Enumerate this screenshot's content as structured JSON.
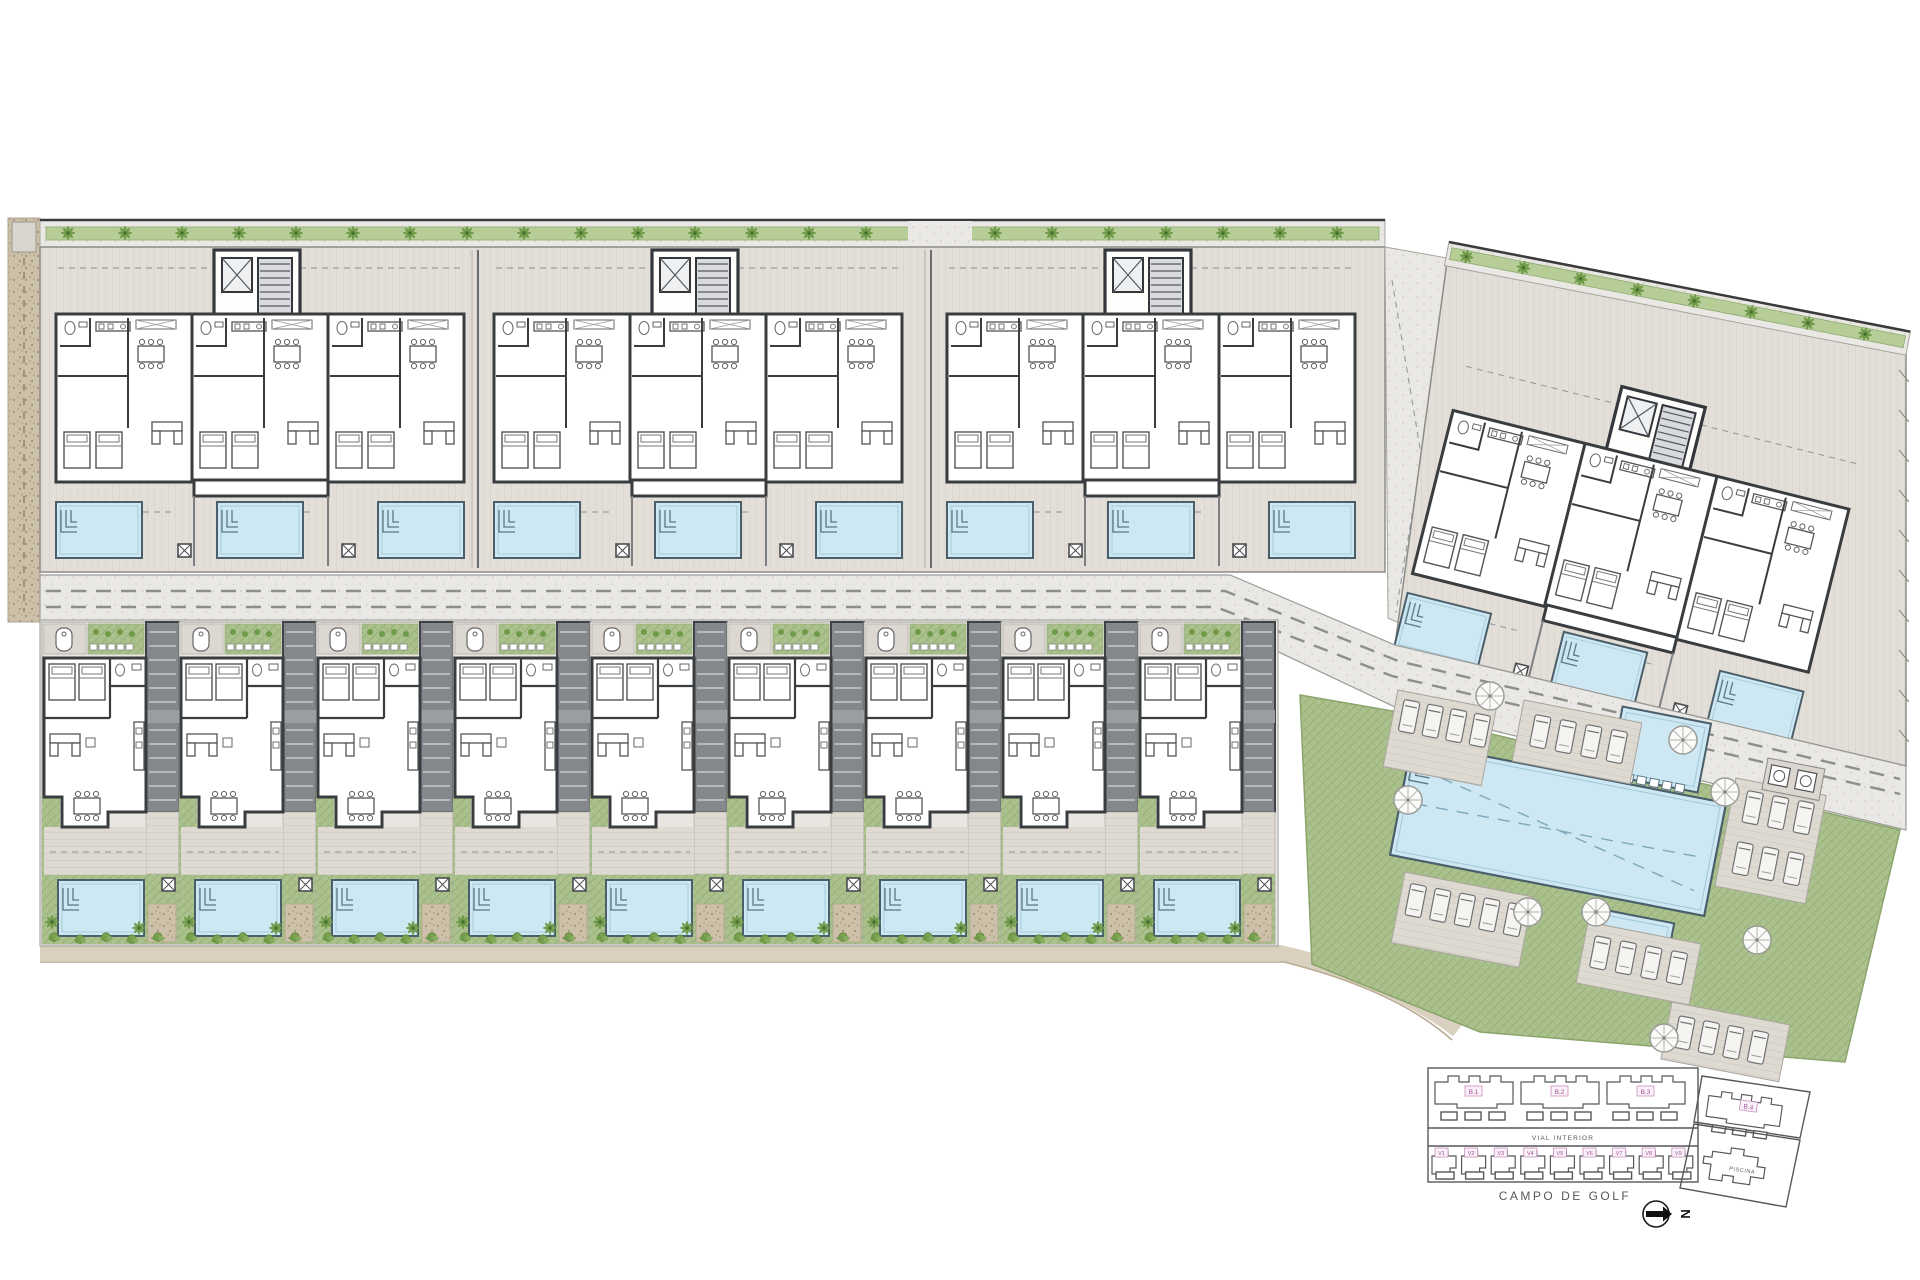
{
  "key_plan": {
    "buildings": [
      "B.1",
      "B.2",
      "B.3",
      "B.4"
    ],
    "villas": [
      "V1",
      "V2",
      "V3",
      "V4",
      "V5",
      "V6",
      "V7",
      "V8",
      "V9"
    ],
    "road_label": "VIAL INTERIOR",
    "pool_area_label": "PISCINA",
    "bottom_label": "CAMPO DE GOLF",
    "north_label": "N"
  },
  "site": {
    "apartment_block_count": 4,
    "villa_count": 9,
    "communal_pool_count": 3,
    "umbrella_count": 8
  },
  "colors": {
    "pool_water": "#cde8f3",
    "pool_edge": "#4b5f6b",
    "lawn_green": "#abc28e",
    "hedge_green": "#6f9a48",
    "deck_grey": "#e3dfd8",
    "road_grey": "#eceae6",
    "wall_dark": "#3a3d40",
    "label_accent": "#a4509a",
    "path_tan": "#cdc0a9"
  }
}
